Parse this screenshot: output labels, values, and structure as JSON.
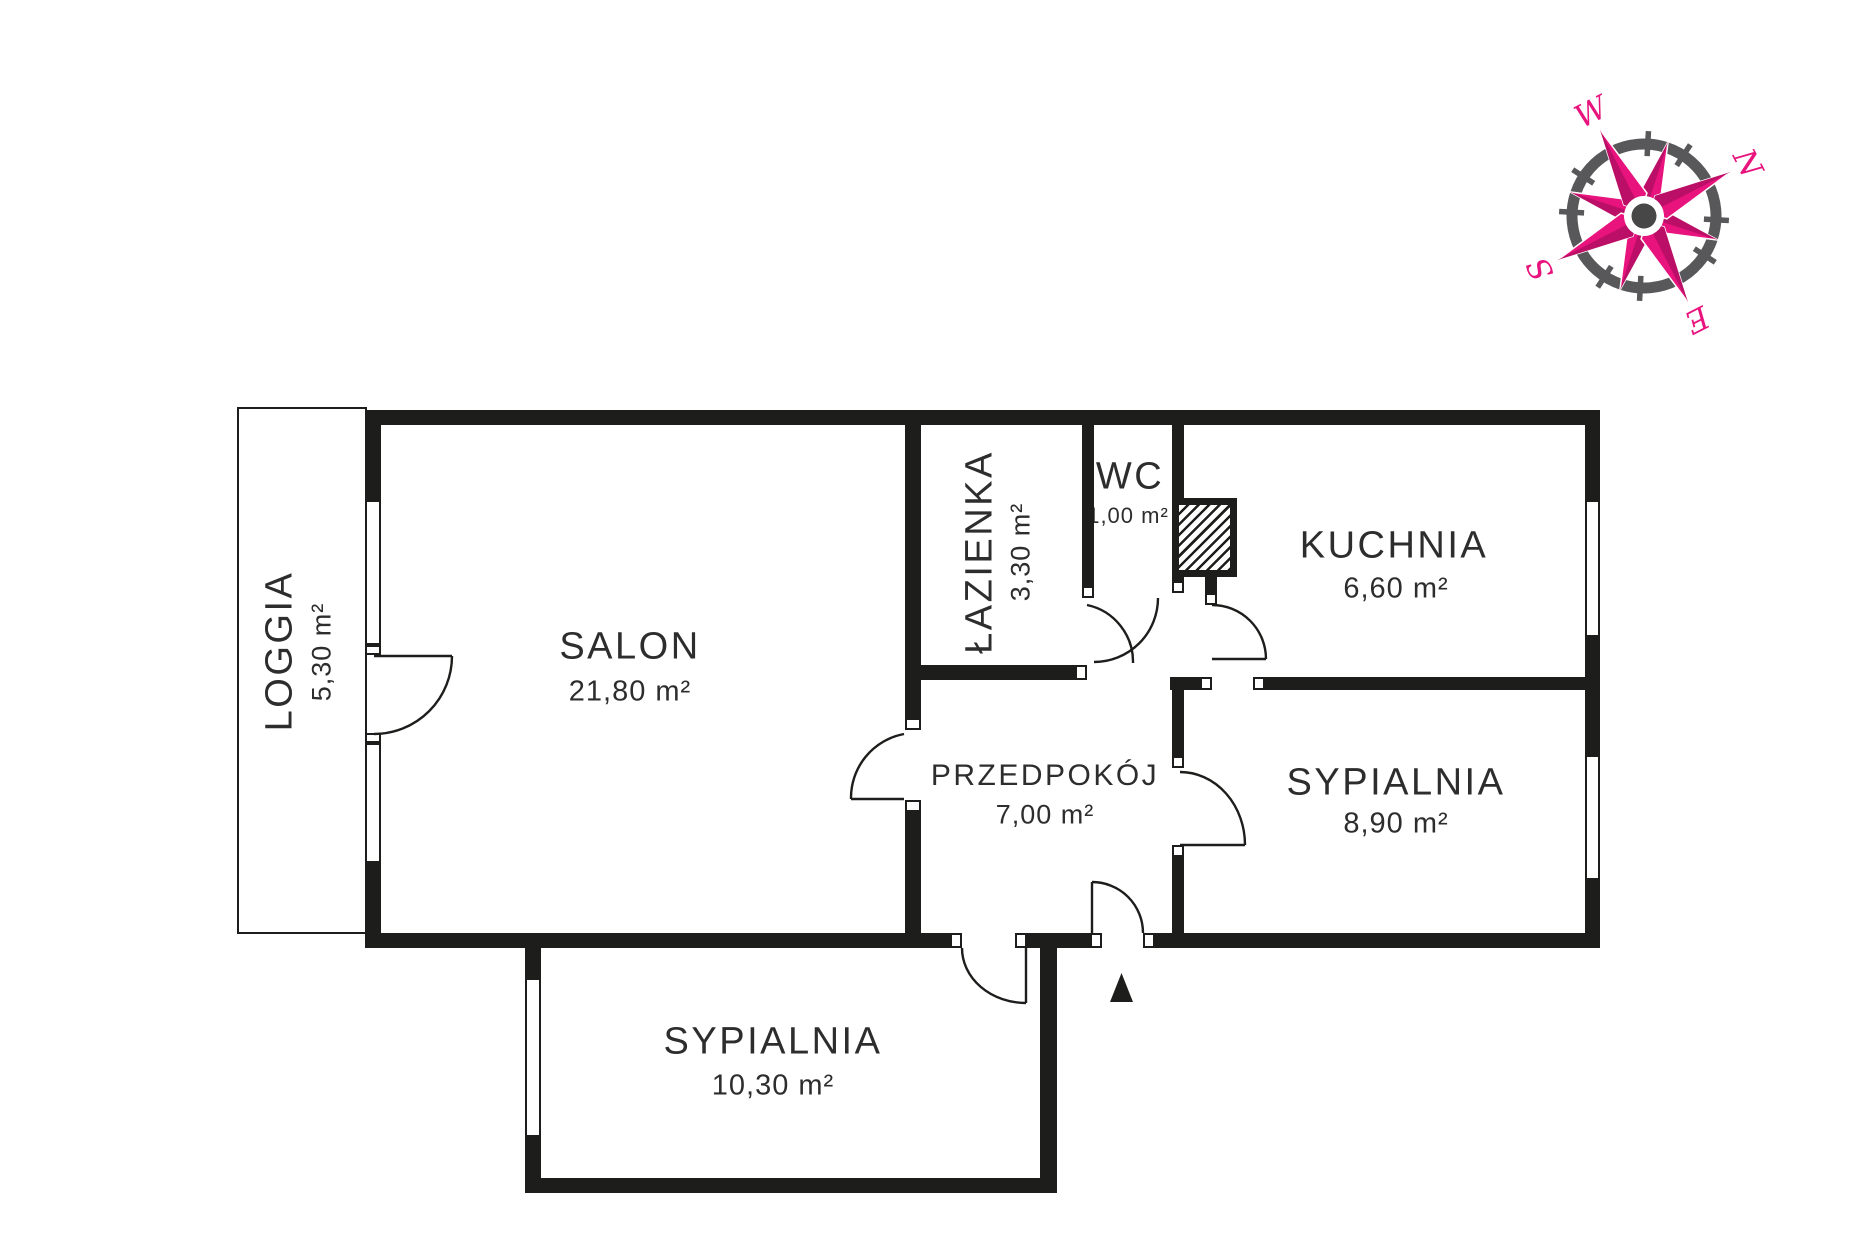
{
  "page": {
    "background": "#ffffff"
  },
  "colors": {
    "wall": "#1d1d1b",
    "text": "#2d2d2d",
    "compass_pink": "#e8137d",
    "compass_pink_dark": "#bb0e66",
    "compass_gray": "#58585a"
  },
  "rooms": {
    "salon": {
      "name": "SALON",
      "area": "21,80 m²"
    },
    "loggia": {
      "name": "LOGGIA",
      "area": "5,30 m²"
    },
    "lazienka": {
      "name": "ŁAZIENKA",
      "area": "3,30 m²"
    },
    "wc": {
      "name": "WC",
      "area": "1,00 m²"
    },
    "kuchnia": {
      "name": "KUCHNIA",
      "area": "6,60 m²"
    },
    "przedpokoj": {
      "name": "PRZEDPOKÓJ",
      "area": "7,00 m²"
    },
    "sypialnia_wschodnia": {
      "name": "SYPIALNIA",
      "area": "8,90 m²"
    },
    "sypialnia_poludniowa": {
      "name": "SYPIALNIA",
      "area": "10,30 m²"
    }
  },
  "compass": {
    "n": "N",
    "e": "E",
    "s": "S",
    "w": "W"
  },
  "icons": {
    "compass": "compass-rose",
    "entrance_marker": "entrance-triangle",
    "shaft": "hatched-duct-shaft",
    "door": "door-swing-arc",
    "window": "window-inset"
  }
}
